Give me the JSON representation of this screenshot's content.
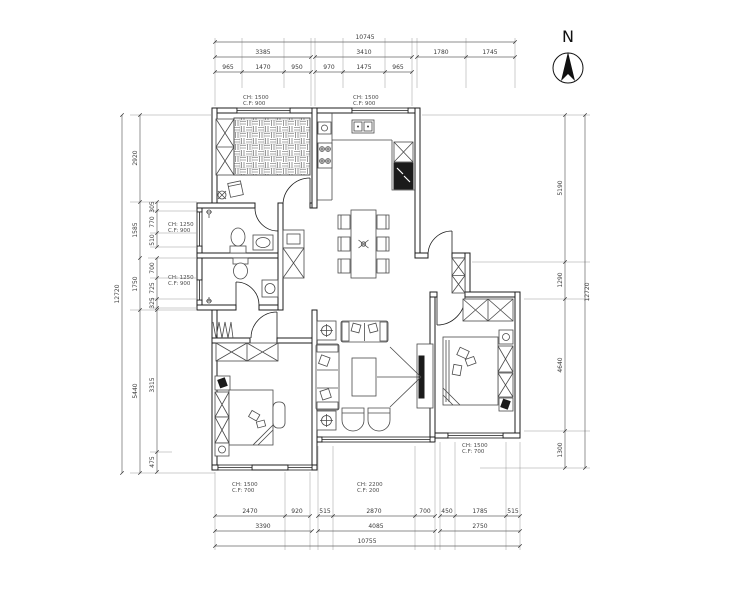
{
  "north": {
    "label": "N"
  },
  "dims": {
    "top": {
      "overall": "10745",
      "row2": [
        "3385",
        "3410",
        "1780",
        "1745"
      ],
      "row3": [
        "965",
        "1470",
        "950",
        "970",
        "1475",
        "965"
      ]
    },
    "bottom": {
      "row1": [
        "2470",
        "920",
        "515",
        "2870",
        "700",
        "450",
        "1785",
        "515"
      ],
      "row2": [
        "3390",
        "4085",
        "2750"
      ],
      "overall": "10755"
    },
    "left": {
      "overall": "12720",
      "mid": [
        "2920",
        "1585",
        "1750",
        "5440"
      ],
      "sub": [
        "305",
        "770",
        "510",
        "700",
        "725",
        "325",
        "3315",
        "475"
      ]
    },
    "right": {
      "overall": "12720",
      "col": [
        "5190",
        "1290",
        "4640",
        "1300"
      ]
    }
  },
  "window_labels": {
    "top_left": [
      "CH: 1500",
      "C.F: 900"
    ],
    "top_right": [
      "CH: 1500",
      "C.F: 900"
    ],
    "bath_upper": [
      "CH: 1250",
      "C.F: 900"
    ],
    "bath_lower": [
      "CH: 1250",
      "C.F: 900"
    ],
    "bedroom2": [
      "CH: 1500",
      "C.F: 700"
    ],
    "living": [
      "CH: 2200",
      "C.F: 200"
    ],
    "master": [
      "CH: 1500",
      "C.F: 700"
    ]
  },
  "colors": {
    "wall": "#1c1c1c",
    "dimension": "#666666",
    "background": "#ffffff",
    "fridge_fill": "#1b1b1b"
  }
}
